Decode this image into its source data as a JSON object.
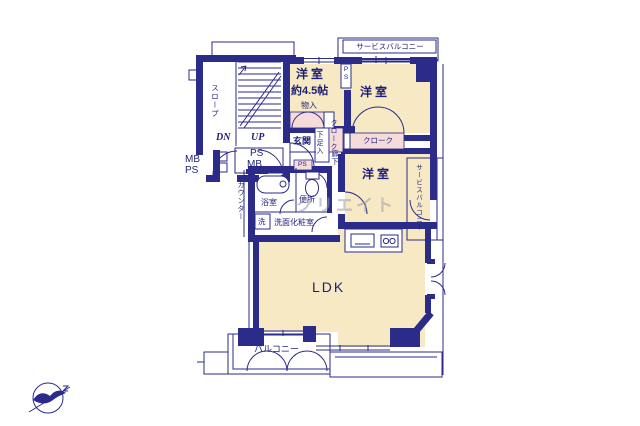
{
  "colors": {
    "wall": "#2b2b8a",
    "line": "#2b2b8a",
    "room": "#f6e9c4",
    "closet": "#f6dcd8",
    "text": "#1e1e78",
    "watermark": "#9a9aa8"
  },
  "rooms": {
    "western_a": {
      "name": "洋室",
      "size": "約4.5帖"
    },
    "western_b": {
      "name": "洋室"
    },
    "western_c": {
      "name": "洋室"
    },
    "ldk": {
      "name": "LDK"
    },
    "entrance": {
      "name": "玄関"
    },
    "bathroom": {
      "name": "浴室"
    },
    "toilet": {
      "name": "便所"
    },
    "washroom": {
      "name": "洗面化粧室"
    },
    "laundry": {
      "name": "洗"
    },
    "storage": {
      "name": "物入"
    },
    "shoe_cabinet": {
      "name": "下足入"
    },
    "cloak_hall": {
      "name": "クローク"
    },
    "cloak_b": {
      "name": "クローク"
    },
    "hallway": {
      "name": "廊下"
    },
    "balcony": {
      "name": "バルコニー"
    },
    "service_balcony_top": {
      "name": "サービスバルコニー"
    },
    "service_balcony_right": {
      "name": "サービスバルコニー"
    },
    "slope": {
      "name": "スロープ"
    },
    "counter": {
      "name": "カウンター"
    }
  },
  "annotations": {
    "down": "DN",
    "up": "UP",
    "shaft_ps": "PS",
    "shaft_mb": "MB",
    "meter_mb": "MB",
    "meter_ps": "PS",
    "ps_pipe_top": "PS",
    "ps_pipe_hall": "PS"
  },
  "watermark": "クリエイト"
}
